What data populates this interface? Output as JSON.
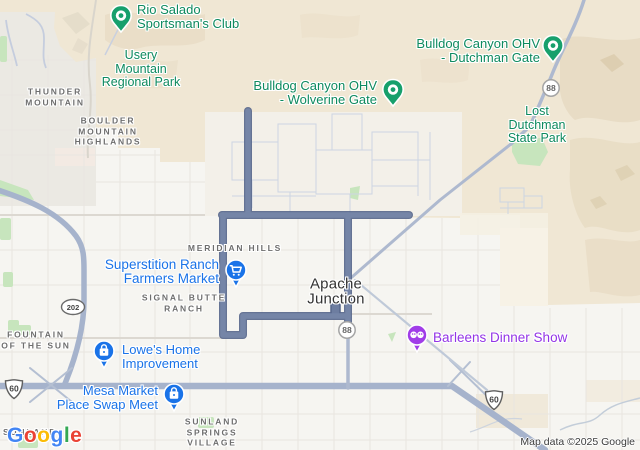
{
  "attribution": "Map data ©2025 Google",
  "logo": {
    "letters": [
      "G",
      "o",
      "o",
      "g",
      "l",
      "e"
    ]
  },
  "colors": {
    "route": "#6d7da0",
    "highway": "#a6b3cc",
    "terrain_tan": "#f0e7d4",
    "park_green": "#c7e5bd",
    "poi_pin_green": "#17a06c",
    "poi_text_green": "#0e8a5f",
    "poi_blue": "#1a73e8",
    "poi_purple": "#a13de8",
    "area_label_gray": "#6e6e6e",
    "city_label": "#333333"
  },
  "pois": {
    "rio_salado": {
      "lines": [
        "Rio Salado",
        "Sportsman's Club"
      ]
    },
    "wolverine": {
      "lines": [
        "Bulldog Canyon OHV",
        "- Wolverine Gate"
      ]
    },
    "dutchman": {
      "lines": [
        "Bulldog Canyon OHV",
        "- Dutchman Gate"
      ]
    },
    "superstition": {
      "lines": [
        "Superstition Ranch",
        "Farmers Market"
      ]
    },
    "lowes": {
      "lines": [
        "Lowe's Home",
        "Improvement"
      ]
    },
    "mesa_market": {
      "lines": [
        "Mesa Market",
        "Place Swap Meet"
      ]
    },
    "barleens": {
      "lines": [
        "Barleens Dinner Show"
      ]
    }
  },
  "parks": {
    "usery": {
      "lines": [
        "Usery",
        "Mountain",
        "Regional Park"
      ]
    },
    "lost_dutchman": {
      "lines": [
        "Lost",
        "Dutchman",
        "State Park"
      ]
    }
  },
  "areas": {
    "thunder_mountain": {
      "lines": [
        "THUNDER",
        "MOUNTAIN"
      ]
    },
    "boulder": {
      "lines": [
        "BOULDER",
        "MOUNTAIN",
        "HIGHLANDS"
      ]
    },
    "meridian_hills": {
      "lines": [
        "MERIDIAN HILLS"
      ]
    },
    "signal_butte": {
      "lines": [
        "SIGNAL BUTTE",
        "RANCH"
      ]
    },
    "fountain": {
      "lines": [
        "FOUNTAIN",
        "OF THE SUN"
      ]
    },
    "sunland_springs": {
      "lines": [
        "SUNLAND",
        "SPRINGS",
        "VILLAGE"
      ]
    },
    "sunland": {
      "lines": [
        "SUNLAND"
      ]
    }
  },
  "city": {
    "lines": [
      "Apache",
      "Junction"
    ]
  },
  "shields": {
    "s88_top": "88",
    "s88_mid": "88",
    "s202": "202",
    "s60_left": "60",
    "s60_right": "60"
  }
}
